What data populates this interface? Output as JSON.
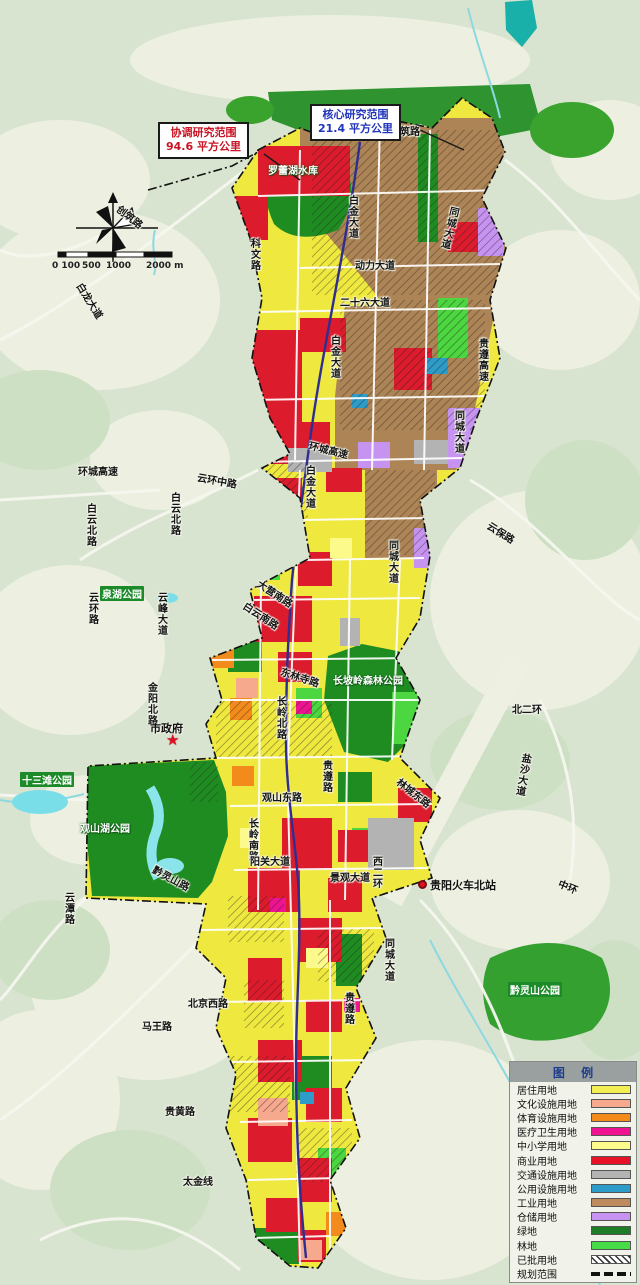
{
  "callouts": {
    "coordination": {
      "line1": "协调研究范围",
      "line2": "94.6 平方公里"
    },
    "core": {
      "line1": "核心研究范围",
      "line2": "21.4 平方公里"
    }
  },
  "scalebar": {
    "t0": "0 100",
    "t1": "500",
    "t2": "1000",
    "t3": "2000 m"
  },
  "roads": [
    {
      "text": "创筑路"
    },
    {
      "text": "创筑路"
    },
    {
      "text": "科文路"
    },
    {
      "text": "白龙大道"
    },
    {
      "text": "动力大道"
    },
    {
      "text": "二十六大道"
    },
    {
      "text": "白金大道"
    },
    {
      "text": "白金大道"
    },
    {
      "text": "白金大道"
    },
    {
      "text": "同城大道"
    },
    {
      "text": "贵遵高速"
    },
    {
      "text": "同城大道"
    },
    {
      "text": "环城高速"
    },
    {
      "text": "环城高速"
    },
    {
      "text": "云环中路"
    },
    {
      "text": "白云北路"
    },
    {
      "text": "白云北路"
    },
    {
      "text": "云保路"
    },
    {
      "text": "云环路"
    },
    {
      "text": "云峰大道"
    },
    {
      "text": "金阳北路"
    },
    {
      "text": "大营南路"
    },
    {
      "text": "白云南路"
    },
    {
      "text": "东林寺路"
    },
    {
      "text": "长岭北路"
    },
    {
      "text": "北二环"
    },
    {
      "text": "盐沙大道"
    },
    {
      "text": "贵遵路"
    },
    {
      "text": "林城东路"
    },
    {
      "text": "观山东路"
    },
    {
      "text": "长岭南路"
    },
    {
      "text": "阳关大道"
    },
    {
      "text": "西二环"
    },
    {
      "text": "景观大道"
    },
    {
      "text": "黔灵山路"
    },
    {
      "text": "云潭路"
    },
    {
      "text": "同城大道"
    },
    {
      "text": "北京西路"
    },
    {
      "text": "马王路"
    },
    {
      "text": "贵黄路"
    },
    {
      "text": "太金线"
    },
    {
      "text": "中环"
    },
    {
      "text": "同城大道"
    },
    {
      "text": "贵遵路"
    }
  ],
  "parks": [
    {
      "text": "罗蕾湖水库"
    },
    {
      "text": "泉湖公园"
    },
    {
      "text": "长坡岭森林公园"
    },
    {
      "text": "十三滩公园"
    },
    {
      "text": "观山湖公园"
    },
    {
      "text": "黔灵山公园"
    }
  ],
  "pois": {
    "government": "市政府",
    "station": "贵阳火车北站"
  },
  "legend": {
    "title": "图 例",
    "items": [
      {
        "label": "居住用地",
        "color": "#f2ef55"
      },
      {
        "label": "文化设施用地",
        "color": "#f6a98d"
      },
      {
        "label": "体育设施用地",
        "color": "#f28a1c"
      },
      {
        "label": "医疗卫生用地",
        "color": "#ee1390"
      },
      {
        "label": "中小学用地",
        "color": "#fdfa8c"
      },
      {
        "label": "商业用地",
        "color": "#e81228"
      },
      {
        "label": "交通设施用地",
        "color": "#b3b3b3"
      },
      {
        "label": "公用设施用地",
        "color": "#2e9cc8"
      },
      {
        "label": "工业用地",
        "color": "#bd8b5e"
      },
      {
        "label": "仓储用地",
        "color": "#c693f0"
      },
      {
        "label": "绿地",
        "color": "#1e7d26"
      },
      {
        "label": "林地",
        "color": "#47dc47"
      },
      {
        "label": "已批用地",
        "pattern": "hatch"
      },
      {
        "label": "规划范围",
        "pattern": "dash"
      }
    ]
  }
}
